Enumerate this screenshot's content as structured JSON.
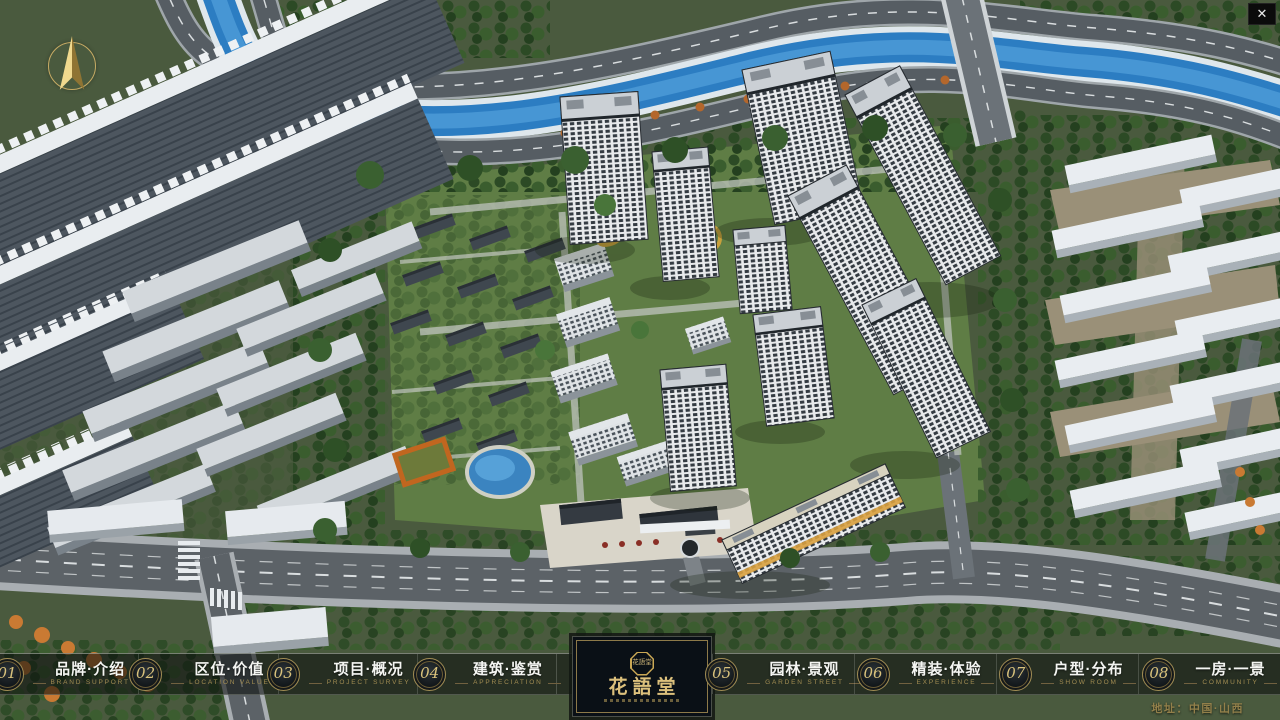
{
  "window": {
    "close_label": "✕"
  },
  "navbar": {
    "items": [
      {
        "id": "brand-intro",
        "num": "01",
        "zh": "品牌·介绍",
        "en": "BRAND SUPPORT"
      },
      {
        "id": "location-value",
        "num": "02",
        "zh": "区位·价值",
        "en": "LOCATION VALUE"
      },
      {
        "id": "project-overview",
        "num": "03",
        "zh": "项目·概况",
        "en": "PROJECT SURVEY"
      },
      {
        "id": "architecture-appreciation",
        "num": "04",
        "zh": "建筑·鉴赏",
        "en": "APPRECIATION"
      },
      {
        "id": "garden-landscape",
        "num": "05",
        "zh": "园林·景观",
        "en": "GARDEN STREET"
      },
      {
        "id": "interior-experience",
        "num": "06",
        "zh": "精装·体验",
        "en": "EXPERIENCE"
      },
      {
        "id": "unit-distribution",
        "num": "07",
        "zh": "户型·分布",
        "en": "SHOW ROOM"
      },
      {
        "id": "room-view",
        "num": "08",
        "zh": "一房·一景",
        "en": "COMMUNITY"
      }
    ]
  },
  "logo": {
    "name": "花語堂",
    "seal": "花語堂"
  },
  "footer": {
    "address": "地址：中国·山西"
  },
  "colors": {
    "gold_accent": "#d9c27c",
    "navbar_bg": "rgba(12,16,13,0.58)",
    "river_blue": "#2c7dc2",
    "logo_gold": "#dcc07c"
  }
}
